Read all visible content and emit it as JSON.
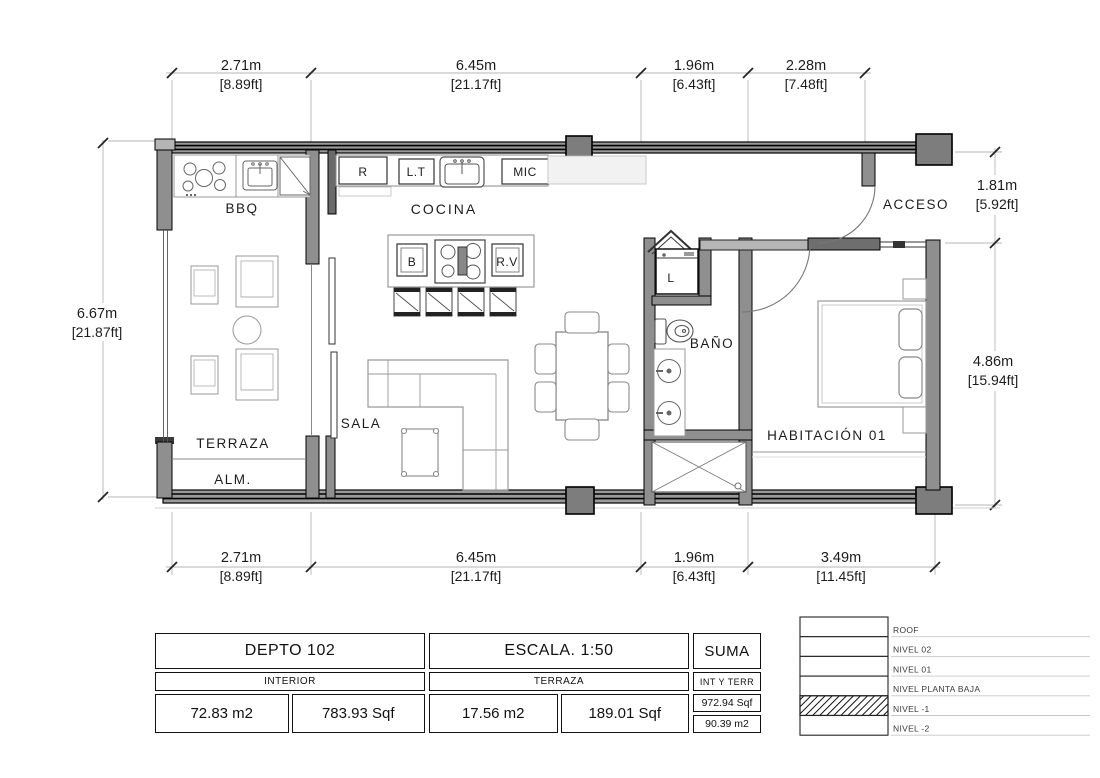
{
  "plan": {
    "rooms": {
      "bbq": "BBQ",
      "cocina": "COCINA",
      "acceso": "ACCESO",
      "bano": "BAÑO",
      "habitacion": "HABITACIÓN 01",
      "terraza": "TERRAZA",
      "alm": "ALM.",
      "sala": "SALA",
      "laundry": "L"
    },
    "appliances": {
      "refrigerator": "R",
      "lt": "L.T",
      "microwave": "MIC",
      "b": "B",
      "rv": "R.V"
    }
  },
  "dimensions": {
    "top": [
      {
        "m": "2.71m",
        "ft": "[8.89ft]"
      },
      {
        "m": "6.45m",
        "ft": "[21.17ft]"
      },
      {
        "m": "1.96m",
        "ft": "[6.43ft]"
      },
      {
        "m": "2.28m",
        "ft": "[7.48ft]"
      }
    ],
    "bottom": [
      {
        "m": "2.71m",
        "ft": "[8.89ft]"
      },
      {
        "m": "6.45m",
        "ft": "[21.17ft]"
      },
      {
        "m": "1.96m",
        "ft": "[6.43ft]"
      },
      {
        "m": "3.49m",
        "ft": "[11.45ft]"
      }
    ],
    "left": [
      {
        "m": "6.67m",
        "ft": "[21.87ft]"
      }
    ],
    "right": [
      {
        "m": "1.81m",
        "ft": "[5.92ft]"
      },
      {
        "m": "4.86m",
        "ft": "[15.94ft]"
      }
    ]
  },
  "info_table": {
    "unit": {
      "title": "DEPTO 102",
      "subtitle": "INTERIOR",
      "m2": "72.83 m2",
      "sqf": "783.93 Sqf"
    },
    "scale": {
      "title": "ESCALA. 1:50",
      "subtitle": "TERRAZA",
      "m2": "17.56 m2",
      "sqf": "189.01 Sqf"
    },
    "suma": {
      "title": "SUMA",
      "subtitle": "INT Y TERR",
      "sqf": "972.94 Sqf",
      "m2": "90.39 m2"
    }
  },
  "levels": [
    "ROOF",
    "NIVEL 02",
    "NIVEL 01",
    "NIVEL PLANTA BAJA",
    "NIVEL -1",
    "NIVEL -2"
  ],
  "colors": {
    "wall": "#8f8f8f",
    "column": "#7d7d7d",
    "line": "#1c1c1c"
  }
}
